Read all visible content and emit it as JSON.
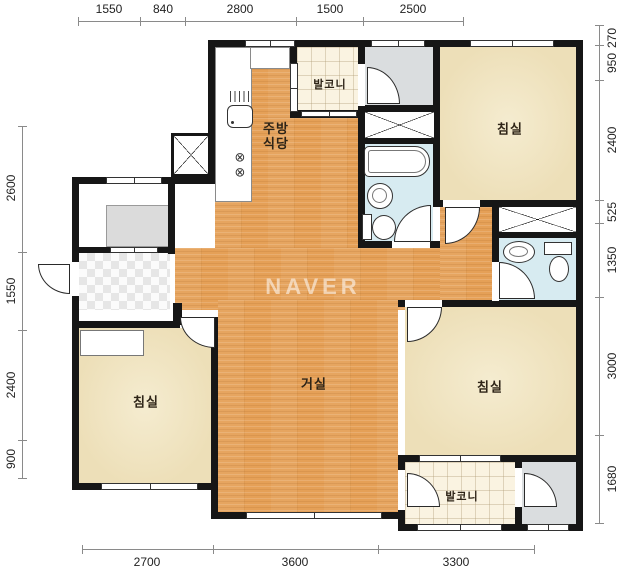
{
  "watermark": "NAVER",
  "rooms": {
    "living": "거실",
    "bedroom": "침실",
    "balcony": "발코니",
    "kitchen_line1": "주방",
    "kitchen_line2": "식당"
  },
  "dimensions": {
    "top": [
      "1550",
      "840",
      "2800",
      "1500",
      "2500"
    ],
    "bottom": [
      "2700",
      "3600",
      "3300"
    ],
    "left": [
      "2600",
      "1550",
      "2400",
      "900"
    ],
    "right": [
      "270",
      "950",
      "2400",
      "525",
      "1350",
      "3000",
      "1680"
    ]
  },
  "colors": {
    "wall": "#161616",
    "wood_floor": "#E5A057",
    "bedroom_floor": "#EDDFB8",
    "balcony_floor": "#FAF3E1",
    "bathroom_floor": "#D7EBF1",
    "utility_floor": "#DADDDF",
    "watermark": "rgba(255,255,255,0.55)"
  }
}
